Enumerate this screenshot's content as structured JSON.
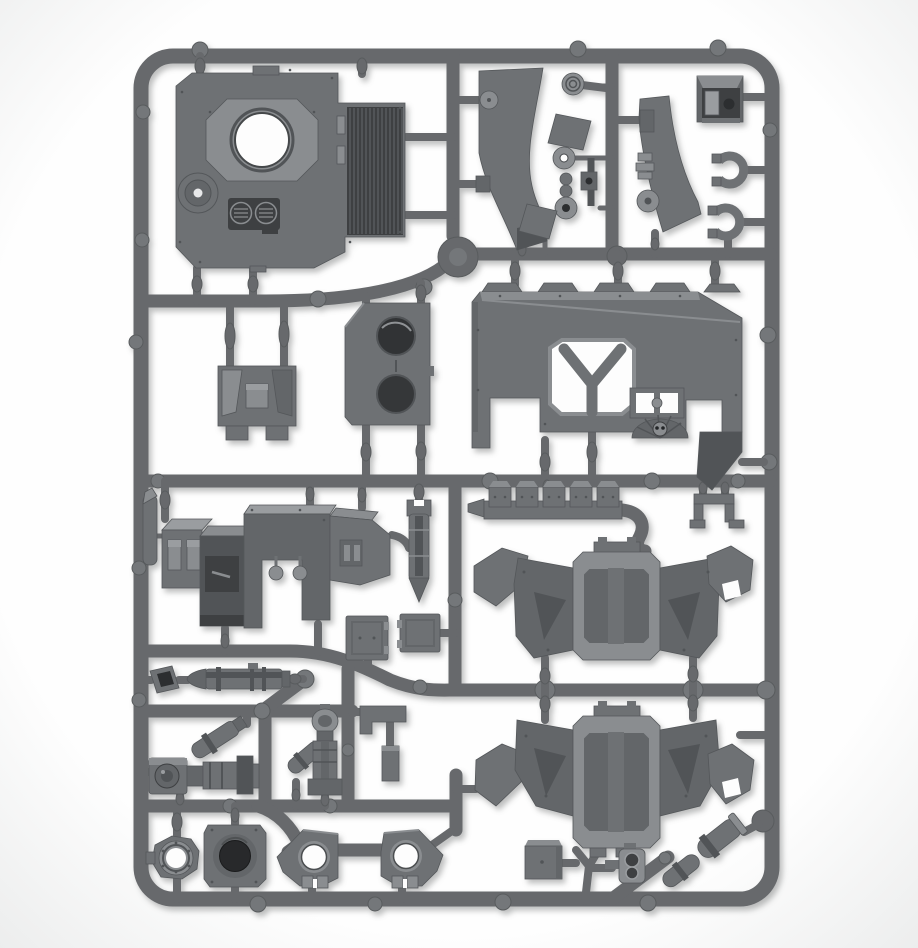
{
  "meta": {
    "title": "Grey plastic model kit sprue — studio product photograph",
    "description": "A single rectangular grey polystyrene sprue (injection-moulded runner frame) densely packed with unpainted model tank components on a plain white background. No text or UI elements are visible in the image.",
    "background": "plain white studio background",
    "material": "grey polystyrene plastic",
    "frame_shape": "rounded rectangle with internal runners, gates and ejector nubs"
  },
  "palette": {
    "bg": "#fdfdfd",
    "vig": "#ebecec",
    "frame": "#67696c",
    "frame-dark": "#595c5e",
    "frame-light": "#74777a",
    "part": "#6e7174",
    "part-light": "#8a8d90",
    "part-lighter": "#9a9da0",
    "part-mid": "#636669",
    "part-dark": "#515457",
    "part-darker": "#3e4042",
    "recess": "#2c2e30",
    "edge": "#54575a"
  },
  "parts": [
    {
      "id": "hull-roof-panel",
      "label": "Hull roof panel with turret ring hole, engine grille, round crew hatch and twin vents"
    },
    {
      "id": "fender-blade-left",
      "label": "Curved track-guard blade (left)"
    },
    {
      "id": "fender-blade-right",
      "label": "Curved track-guard blade (right)"
    },
    {
      "id": "lamp-disc",
      "label": "Ribbed lamp disc"
    },
    {
      "id": "linkage-set",
      "label": "Small linkage plates, pulley discs and turnbuckle"
    },
    {
      "id": "cupola-box",
      "label": "Open cupola / stowage box"
    },
    {
      "id": "pintle-clip-1",
      "label": "C-shaped pintle clip (upper)"
    },
    {
      "id": "pintle-clip-2",
      "label": "C-shaped pintle clip (lower)"
    },
    {
      "id": "rear-hull-plate",
      "label": "Rear hull plate with Y-strut cutout, twin vision port and winged-skull emblem"
    },
    {
      "id": "hatch-bracket",
      "label": "Hatch mounting bracket with centre knob"
    },
    {
      "id": "twin-port-plate",
      "label": "Side plate with two circular ports"
    },
    {
      "id": "periscope-block",
      "label": "Periscope block"
    },
    {
      "id": "sponson-cluster",
      "label": "Sponson / turret housing cluster of boxes with hinge pegs and knobs"
    },
    {
      "id": "finned-bomb",
      "label": "Finned bomb / shell (vertical)"
    },
    {
      "id": "hatch-door-1",
      "label": "Square access hatch door (large)"
    },
    {
      "id": "hatch-door-2",
      "label": "Square access hatch door (small)"
    },
    {
      "id": "track-link-strip",
      "label": "Strip of five track links"
    },
    {
      "id": "u-bracket",
      "label": "U-shaped mounting bracket"
    },
    {
      "id": "hull-side-upper",
      "label": "Winged hull section with recessed octagonal panel (upper)"
    },
    {
      "id": "hull-side-lower",
      "label": "Winged hull section with recessed octagonal panel (lower)"
    },
    {
      "id": "torpedo-shell",
      "label": "Cylindrical shell / fuel drum (horizontal)"
    },
    {
      "id": "square-funnel",
      "label": "Square intake funnel"
    },
    {
      "id": "searchlight-assembly",
      "label": "Searchlight / gun body with angled recoil cylinder"
    },
    {
      "id": "piston-column",
      "label": "Vertical piston column with angled cylinder"
    },
    {
      "id": "l-bracket",
      "label": "L-shaped bracket with backing plate"
    },
    {
      "id": "ring-collar",
      "label": "Turret ring collar with open centre"
    },
    {
      "id": "bore-block",
      "label": "Weapon bore block with deep circular bore"
    },
    {
      "id": "gun-mount-1",
      "label": "Ball-type weapon mount with open ring (left)"
    },
    {
      "id": "gun-mount-2",
      "label": "Ball-type weapon mount with open ring (right)"
    },
    {
      "id": "stowage-box",
      "label": "Small stowage box"
    },
    {
      "id": "twin-headlight",
      "label": "Twin-lens headlamp unit"
    },
    {
      "id": "exhaust-pipes",
      "label": "Angled exhaust pipe sections with collar bands"
    }
  ]
}
